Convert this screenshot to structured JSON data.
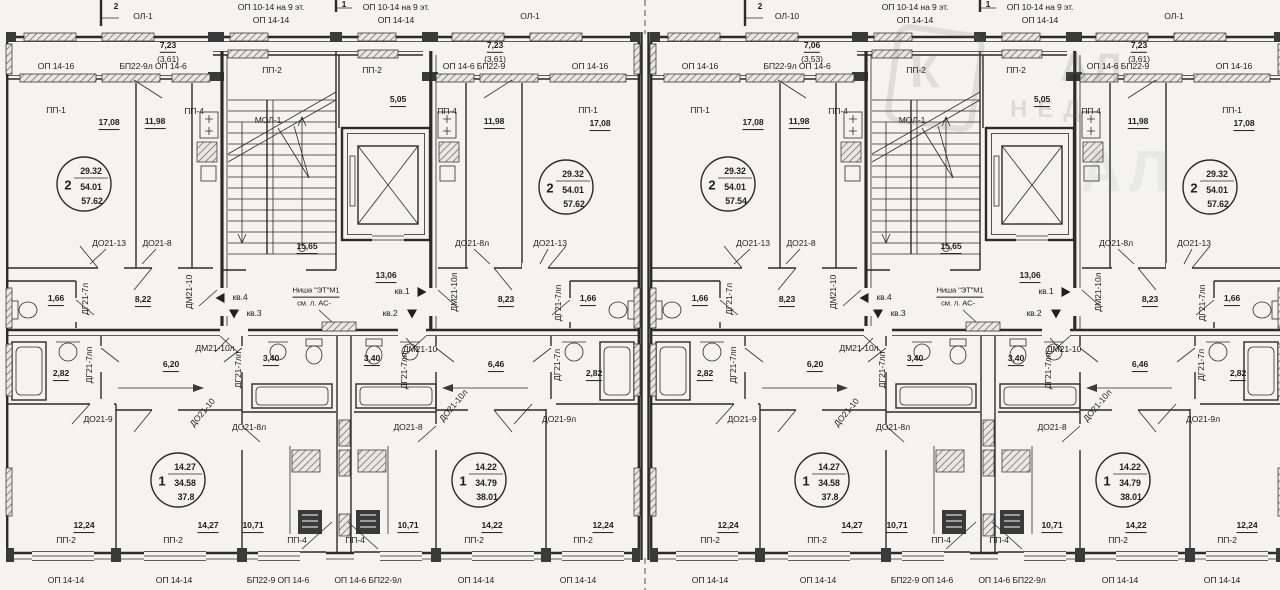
{
  "shared": {
    "mark1": "1",
    "mark2": "2",
    "ol1": "ОЛ-1",
    "op1016": "ОП 10-14 на 9 эт.",
    "op1414": "ОП 14-14",
    "op1416": "ОП 14-16",
    "bp_l_146": "БП22-9л ОП 14-6",
    "op146_bp": "ОП 14-6  БП22-9",
    "bp_146": "БП22-9  ОП 14-6",
    "op146_bpl": "ОП 14-6  БП22-9л",
    "d723": "7,23",
    "d361": "(3,61)",
    "pp1": "ПП-1",
    "pp2": "ПП-2",
    "pp4": "ПП-4",
    "mol1": "МОЛ-1",
    "d1708": "17,08",
    "d1198": "11,98",
    "d505": "5,05",
    "d1565": "15,65",
    "d1306": "13,06",
    "d166": "1,66",
    "d823": "8,23",
    "d282": "2,82",
    "d620": "6,20",
    "d646": "6,46",
    "d340": "3,40",
    "d1224": "12,24",
    "d1427": "14,27",
    "d1071": "10,71",
    "d1422": "14,22",
    "do2113": "ДО21-13",
    "do218": "ДО21-8",
    "do218l": "ДО21-8л",
    "do219": "ДО21-9",
    "do219l": "ДО21-9л",
    "do2110": "ДО21-10",
    "do2110l": "ДО21-10л",
    "dm2110": "ДМ21-10",
    "dm2110l": "ДМ21-10л",
    "dg217l": "ДГ21-7л",
    "dg217lp": "ДГ21-7лп",
    "kv1": "кв.1",
    "kv2": "кв.2",
    "kv3": "кв.3",
    "kv4": "кв.4",
    "nisha1": "Ниша \"ЭТ\"М1",
    "nisha2": "см. л. АС-"
  },
  "sec": {
    "a": {
      "balcony_name": "ОЛ-1",
      "dim_top": "7,23",
      "dim_bot": "(3,61)",
      "hall_left": "8,22",
      "stamp1_full": "57.62"
    },
    "b": {
      "balcony_name": "ОЛ-10",
      "dim_top": "7,06",
      "dim_bot": "(3,53)",
      "hall_left": "8,23",
      "stamp1_full": "57.54"
    }
  },
  "stamps": {
    "u": {
      "rooms": "2",
      "living": "29.32",
      "total": "54.01",
      "full_b": "57.62"
    },
    "la": {
      "rooms": "1",
      "living": "14.27",
      "total": "34.58",
      "full": "37.8"
    },
    "lb": {
      "rooms": "1",
      "living": "14.22",
      "total": "34.79",
      "full": "38.01"
    }
  },
  "watermark": {
    "letter": "К",
    "frag1": "АЛ",
    "frag2": "НЕД"
  },
  "palette": {
    "paper": "#f4f3ef",
    "ink": "#2b2b2b"
  }
}
